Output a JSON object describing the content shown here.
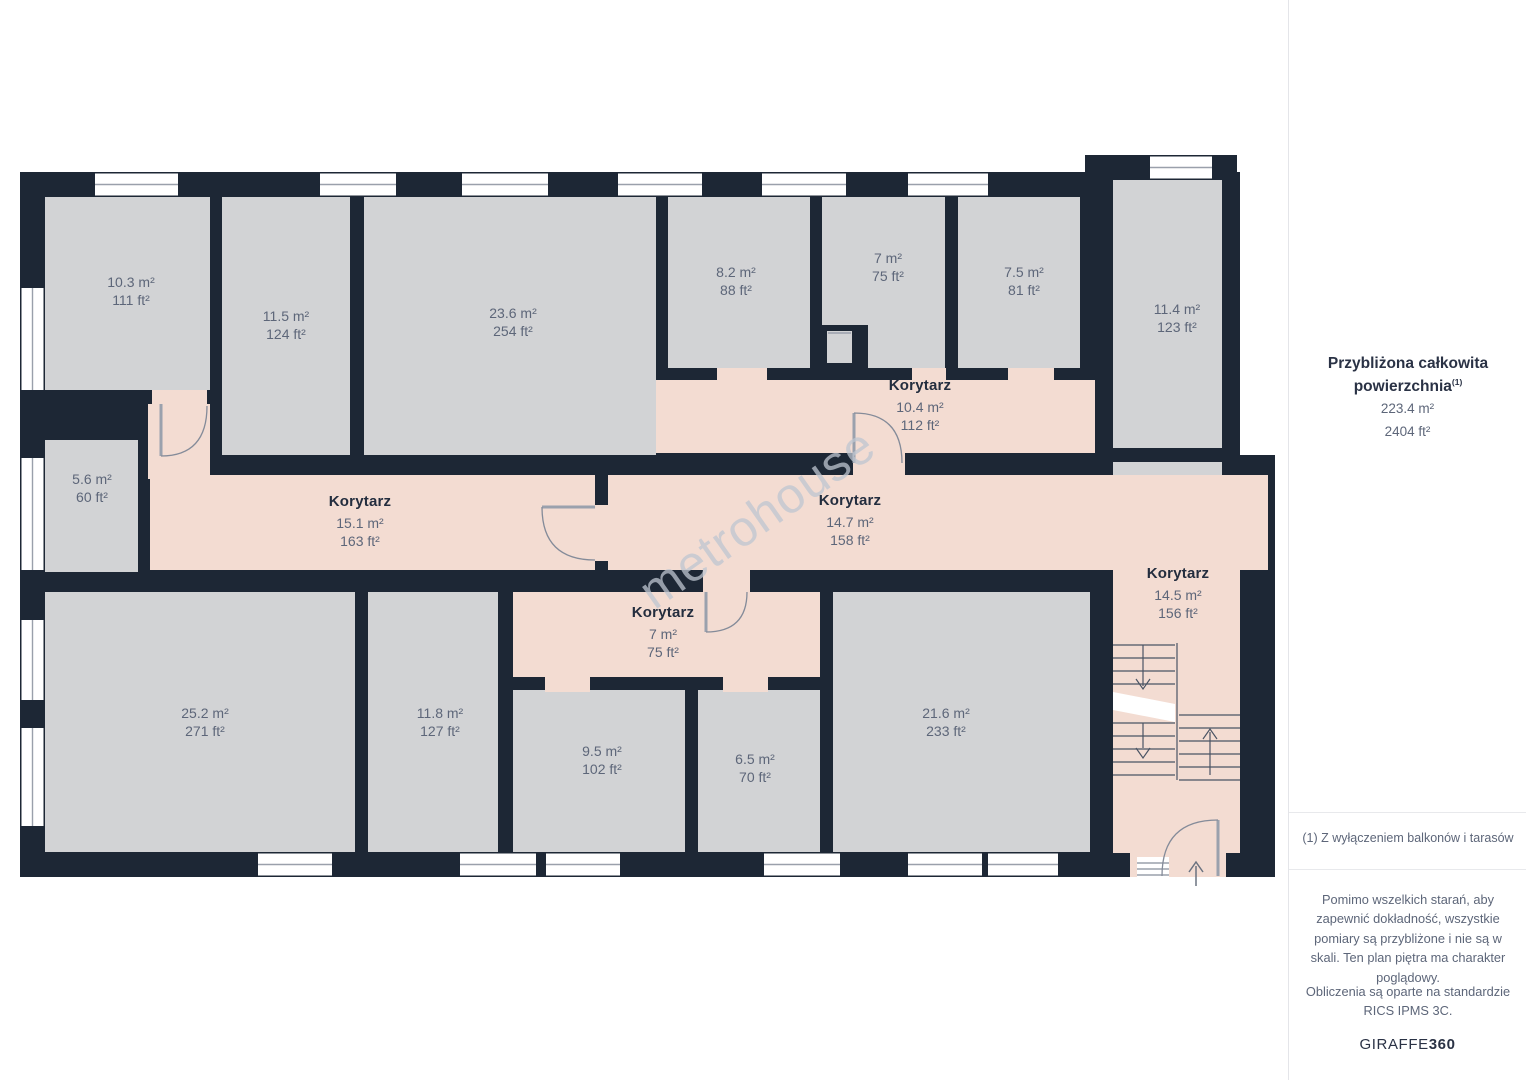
{
  "plan": {
    "watermark": "metrohouse",
    "rooms": [
      {
        "name": "",
        "m2": "10.3 m²",
        "ft2": "111 ft²"
      },
      {
        "name": "",
        "m2": "11.5 m²",
        "ft2": "124 ft²"
      },
      {
        "name": "",
        "m2": "23.6 m²",
        "ft2": "254 ft²"
      },
      {
        "name": "",
        "m2": "8.2 m²",
        "ft2": "88 ft²"
      },
      {
        "name": "",
        "m2": "7 m²",
        "ft2": "75 ft²"
      },
      {
        "name": "",
        "m2": "7.5 m²",
        "ft2": "81 ft²"
      },
      {
        "name": "",
        "m2": "11.4 m²",
        "ft2": "123 ft²"
      },
      {
        "name": "Korytarz",
        "m2": "10.4 m²",
        "ft2": "112 ft²"
      },
      {
        "name": "",
        "m2": "5.6 m²",
        "ft2": "60 ft²"
      },
      {
        "name": "Korytarz",
        "m2": "15.1 m²",
        "ft2": "163 ft²"
      },
      {
        "name": "Korytarz",
        "m2": "14.7 m²",
        "ft2": "158 ft²"
      },
      {
        "name": "Korytarz",
        "m2": "14.5 m²",
        "ft2": "156 ft²"
      },
      {
        "name": "Korytarz",
        "m2": "7 m²",
        "ft2": "75 ft²"
      },
      {
        "name": "",
        "m2": "25.2 m²",
        "ft2": "271 ft²"
      },
      {
        "name": "",
        "m2": "11.8 m²",
        "ft2": "127 ft²"
      },
      {
        "name": "",
        "m2": "9.5 m²",
        "ft2": "102 ft²"
      },
      {
        "name": "",
        "m2": "6.5 m²",
        "ft2": "70 ft²"
      },
      {
        "name": "",
        "m2": "21.6 m²",
        "ft2": "233 ft²"
      }
    ]
  },
  "sidebar": {
    "title": "Przybliżona całkowita powierzchnia",
    "title_sup": "(1)",
    "total_m2": "223.4 m²",
    "total_ft2": "2404 ft²",
    "footnote": "(1) Z wyłączeniem balkonów i tarasów",
    "disclaimer": "Pomimo wszelkich starań, aby zapewnić dokładność, wszystkie pomiary są przybliżone i nie są w skali. Ten plan piętra ma charakter poglądowy.",
    "standard": "Obliczenia są oparte na standardzie RICS IPMS 3C.",
    "logo_primary": "GIRAFFE",
    "logo_secondary": "360"
  },
  "colors": {
    "wall": "#1d2735",
    "room_fill": "#d2d3d5",
    "corridor_fill": "#f3dcd2",
    "label_text": "#5d6679",
    "heading_text": "#2a3245"
  }
}
